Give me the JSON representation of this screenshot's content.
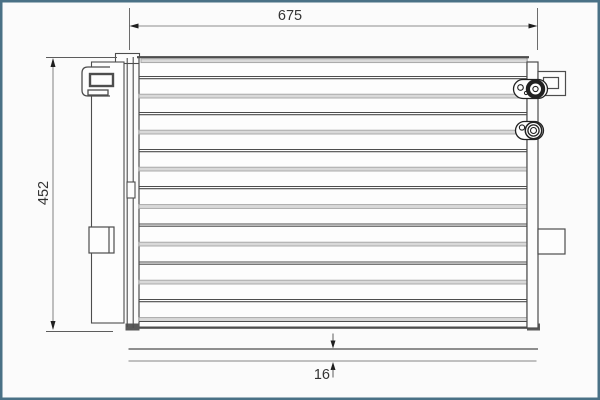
{
  "diagram": {
    "kind": "technical-drawing-condenser",
    "dimensions": {
      "width_label": "675",
      "height_label": "452",
      "depth_label": "16"
    }
  },
  "colors": {
    "frame": "#4a7186",
    "outline": "#4d4d4d",
    "outline_strong": "#222222",
    "gray_line": "#9c9c9c",
    "dim_line": "#8c8c8c",
    "dim_ext": "#5c5c5c",
    "arrow": "#1f1f1f",
    "text": "#333333"
  }
}
